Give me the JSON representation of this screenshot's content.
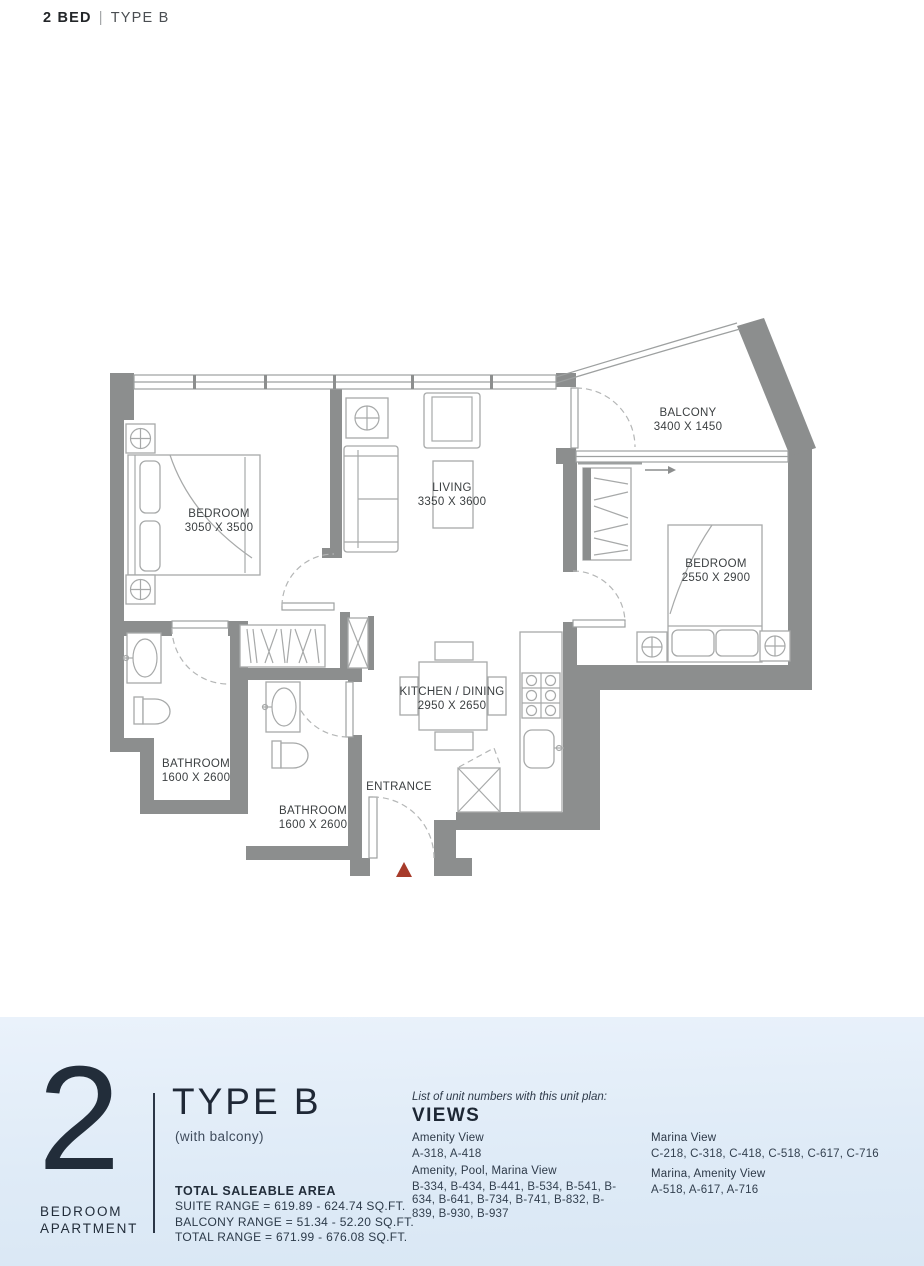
{
  "header": {
    "title_bold": "2 BED",
    "separator": "|",
    "title_light": "TYPE B"
  },
  "plan": {
    "rooms": {
      "bedroom1": {
        "name": "BEDROOM",
        "dims": "3050 X 3500"
      },
      "living": {
        "name": "LIVING",
        "dims": "3350 X 3600"
      },
      "balcony": {
        "name": "BALCONY",
        "dims": "3400 X 1450"
      },
      "bedroom2": {
        "name": "BEDROOM",
        "dims": "2550 X 2900"
      },
      "bathroom1": {
        "name": "BATHROOM",
        "dims": "1600 X 2600"
      },
      "bathroom2": {
        "name": "BATHROOM",
        "dims": "1600 X 2600"
      },
      "kitchen": {
        "name": "KITCHEN / DINING",
        "dims": "2950 X 2650"
      },
      "entrance": {
        "name": "ENTRANCE",
        "dims": ""
      }
    },
    "colors": {
      "wall": "#8c8e8e",
      "furniture_line": "#a7a9a9",
      "label_text": "#3c4042",
      "entry_marker": "#a73b2a"
    }
  },
  "footer": {
    "unit_number": "2",
    "unit_label": "BEDROOM\nAPARTMENT",
    "type_title": "TYPE B",
    "type_subtitle": "(with balcony)",
    "panel_bg": "#e3eefa",
    "area": {
      "heading": "TOTAL SALEABLE AREA",
      "suite": "SUITE RANGE = 619.89 - 624.74 SQ.FT.",
      "balcony": "BALCONY RANGE = 51.34 - 52.20 SQ.FT.",
      "total": "TOTAL RANGE = 671.99 - 676.08 SQ.FT."
    },
    "views": {
      "note": "List of unit numbers with this unit plan:",
      "heading": "VIEWS",
      "groups": [
        {
          "label": "Amenity View",
          "units": "A-318, A-418"
        },
        {
          "label": "Amenity, Pool, Marina View",
          "units": "B-334, B-434, B-441, B-534, B-541, B-634, B-641, B-734, B-741, B-832, B-839, B-930, B-937"
        },
        {
          "label": "Marina View",
          "units": "C-218, C-318, C-418, C-518, C-617, C-716"
        },
        {
          "label": "Marina, Amenity View",
          "units": "A-518, A-617, A-716"
        }
      ]
    }
  }
}
